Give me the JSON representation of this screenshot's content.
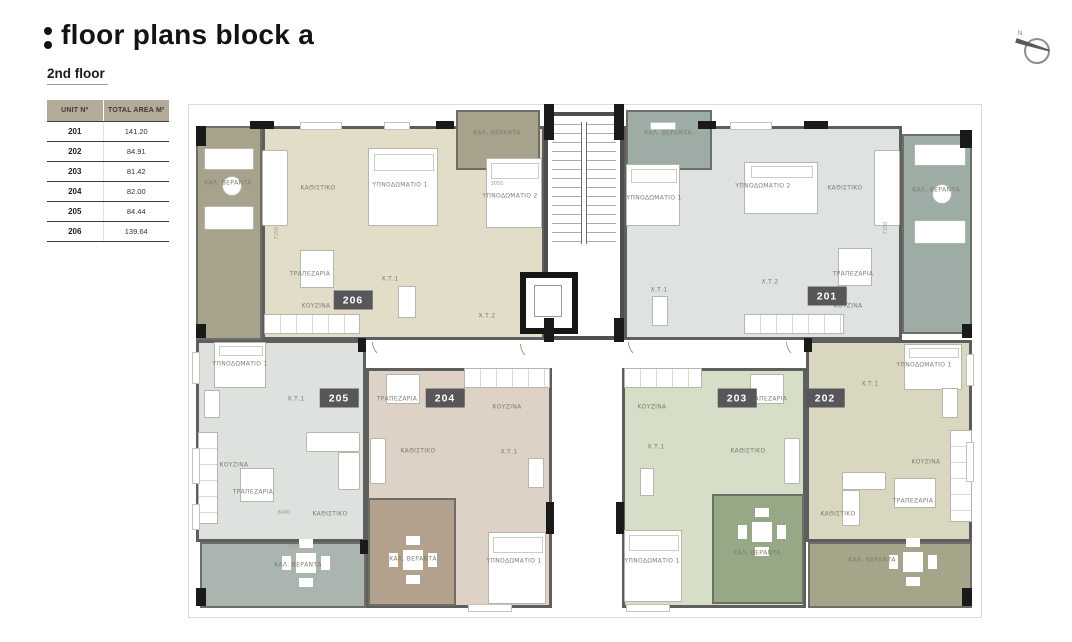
{
  "header": {
    "title": "floor plans block a",
    "subtitle": "2nd floor"
  },
  "table": {
    "headers": [
      "UNIT Nº",
      "TOTAL AREA M²"
    ],
    "rows": [
      {
        "unit": "201",
        "area": "141.20"
      },
      {
        "unit": "202",
        "area": "84.91"
      },
      {
        "unit": "203",
        "area": "81.42"
      },
      {
        "unit": "204",
        "area": "82.00"
      },
      {
        "unit": "205",
        "area": "84.44"
      },
      {
        "unit": "206",
        "area": "139.64"
      }
    ]
  },
  "compass": {
    "label": "N"
  },
  "plan": {
    "badges": [
      {
        "number": "206",
        "x": 353,
        "y": 300
      },
      {
        "number": "201",
        "x": 827,
        "y": 296
      },
      {
        "number": "205",
        "x": 339,
        "y": 398
      },
      {
        "number": "204",
        "x": 445,
        "y": 398
      },
      {
        "number": "203",
        "x": 737,
        "y": 398
      },
      {
        "number": "202",
        "x": 825,
        "y": 398
      }
    ],
    "room_labels": [
      {
        "text": "ΚΑΛ. ΒΕΡΑΝΤΑ",
        "x": 228,
        "y": 183
      },
      {
        "text": "ΚΑΘΙΣΤΙΚΟ",
        "x": 318,
        "y": 188
      },
      {
        "text": "ΥΠΝΟΔΩΜΑΤΙΟ 1",
        "x": 400,
        "y": 185
      },
      {
        "text": "ΥΠΝΟΔΩΜΑΤΙΟ 2",
        "x": 510,
        "y": 196
      },
      {
        "text": "ΤΡΑΠΕΖΑΡΙΑ",
        "x": 310,
        "y": 274
      },
      {
        "text": "ΚΟΥΖΙΝΑ",
        "x": 316,
        "y": 306
      },
      {
        "text": "Χ.Τ.1",
        "x": 390,
        "y": 279
      },
      {
        "text": "Χ.Τ.2",
        "x": 487,
        "y": 316
      },
      {
        "text": "ΚΑΛ. ΒΕΡΑΝΤΑ",
        "x": 497,
        "y": 133
      },
      {
        "text": "ΚΑΛ. ΒΕΡΑΝΤΑ",
        "x": 668,
        "y": 133
      },
      {
        "text": "ΥΠΝΟΔΩΜΑΤΙΟ 1",
        "x": 654,
        "y": 198
      },
      {
        "text": "ΥΠΝΟΔΩΜΑΤΙΟ 2",
        "x": 763,
        "y": 186
      },
      {
        "text": "ΚΑΘΙΣΤΙΚΟ",
        "x": 845,
        "y": 188
      },
      {
        "text": "ΚΑΛ. ΒΕΡΑΝΤΑ",
        "x": 936,
        "y": 190
      },
      {
        "text": "Χ.Τ.1",
        "x": 659,
        "y": 290
      },
      {
        "text": "Χ.Τ.2",
        "x": 770,
        "y": 282
      },
      {
        "text": "ΤΡΑΠΕΖΑΡΙΑ",
        "x": 853,
        "y": 274
      },
      {
        "text": "ΚΟΥΖΙΝΑ",
        "x": 848,
        "y": 306
      },
      {
        "text": "ΥΠΝΟΔΩΜΑΤΙΟ 1",
        "x": 240,
        "y": 364
      },
      {
        "text": "Χ.Τ.1",
        "x": 296,
        "y": 399
      },
      {
        "text": "ΚΟΥΖΙΝΑ",
        "x": 234,
        "y": 465
      },
      {
        "text": "ΤΡΑΠΕΖΑΡΙΑ",
        "x": 253,
        "y": 492
      },
      {
        "text": "ΚΑΘΙΣΤΙΚΟ",
        "x": 330,
        "y": 514
      },
      {
        "text": "ΚΑΛ. ΒΕΡΑΝΤΑ",
        "x": 298,
        "y": 565
      },
      {
        "text": "ΤΡΑΠΕΖΑΡΙΑ",
        "x": 397,
        "y": 399
      },
      {
        "text": "ΚΟΥΖΙΝΑ",
        "x": 507,
        "y": 407
      },
      {
        "text": "ΚΑΘΙΣΤΙΚΟ",
        "x": 418,
        "y": 451
      },
      {
        "text": "Χ.Τ.1",
        "x": 509,
        "y": 452
      },
      {
        "text": "ΚΑΛ. ΒΕΡΑΝΤΑ",
        "x": 413,
        "y": 559
      },
      {
        "text": "ΥΠΝΟΔΩΜΑΤΙΟ 1",
        "x": 514,
        "y": 561
      },
      {
        "text": "ΚΟΥΖΙΝΑ",
        "x": 652,
        "y": 407
      },
      {
        "text": "ΤΡΑΠΕΖΑΡΙΑ",
        "x": 767,
        "y": 399
      },
      {
        "text": "Χ.Τ.1",
        "x": 656,
        "y": 447
      },
      {
        "text": "ΚΑΘΙΣΤΙΚΟ",
        "x": 748,
        "y": 451
      },
      {
        "text": "ΥΠΝΟΔΩΜΑΤΙΟ 1",
        "x": 652,
        "y": 561
      },
      {
        "text": "ΚΑΛ. ΒΕΡΑΝΤΑ",
        "x": 757,
        "y": 553
      },
      {
        "text": "Χ.Τ.1",
        "x": 870,
        "y": 384
      },
      {
        "text": "ΥΠΝΟΔΩΜΑΤΙΟ 1",
        "x": 924,
        "y": 365
      },
      {
        "text": "ΚΟΥΖΙΝΑ",
        "x": 926,
        "y": 462
      },
      {
        "text": "ΤΡΑΠΕΖΑΡΙΑ",
        "x": 913,
        "y": 501
      },
      {
        "text": "ΚΑΘΙΣΤΙΚΟ",
        "x": 838,
        "y": 514
      },
      {
        "text": "ΚΑΛ. ΒΕΡΑΝΤΑ",
        "x": 872,
        "y": 560
      }
    ],
    "dim_labels": [
      {
        "text": "8400",
        "x": 284,
        "y": 513
      },
      {
        "text": "5890",
        "x": 294,
        "y": 547
      },
      {
        "text": "7250",
        "x": 277,
        "y": 233,
        "rot": -90
      },
      {
        "text": "7250",
        "x": 886,
        "y": 228,
        "rot": -90
      },
      {
        "text": "3050",
        "x": 497,
        "y": 184
      }
    ],
    "colors": {
      "c206f": "#e1ddc9",
      "c206v": "#a7a28b",
      "c201f": "#dee3e1",
      "c201v": "#9dada5",
      "c205f": "#dde2df",
      "c205v": "#a9b5ae",
      "c204f": "#ddd2c5",
      "c204v": "#b3a08d",
      "c203f": "#d6dec7",
      "c203v": "#97a887",
      "c202f": "#dad7c0",
      "c202v": "#a5a589",
      "wall": "#5e5e5e",
      "badge_bg": "#57575a",
      "table_header_bg": "#b2ab99"
    }
  }
}
